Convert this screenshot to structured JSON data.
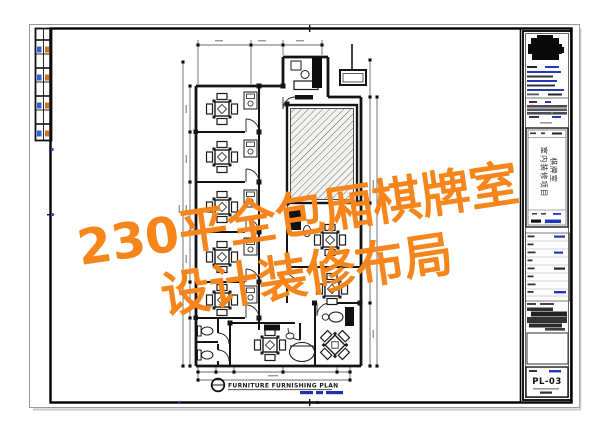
{
  "watermark": {
    "line1": "230平全包厢棋牌室",
    "line2": "设计装修布局",
    "color": "#F6861B"
  },
  "plan": {
    "caption_title": "FURNITURE FURNISHING PLAN"
  },
  "title_block": {
    "project_name_line1": "棋牌室",
    "project_name_line2": "室内装修项目",
    "sheet_number": "PL-03"
  },
  "colors": {
    "wall": "#141414",
    "dimension_line": "#3a3a3a",
    "hatch_background": "#f2f2f0",
    "hatch_line": "#6e6e6e",
    "accent_blue": "#2238b8",
    "accent_orange": "#c8742f",
    "watermark_orange": "#F6861B"
  },
  "icons": [
    "mahjong-table-icon",
    "desk-icon",
    "toilet-icon",
    "door-arc-icon",
    "detail-bubble-icon",
    "company-logo-blob",
    "sign-board-icon"
  ]
}
